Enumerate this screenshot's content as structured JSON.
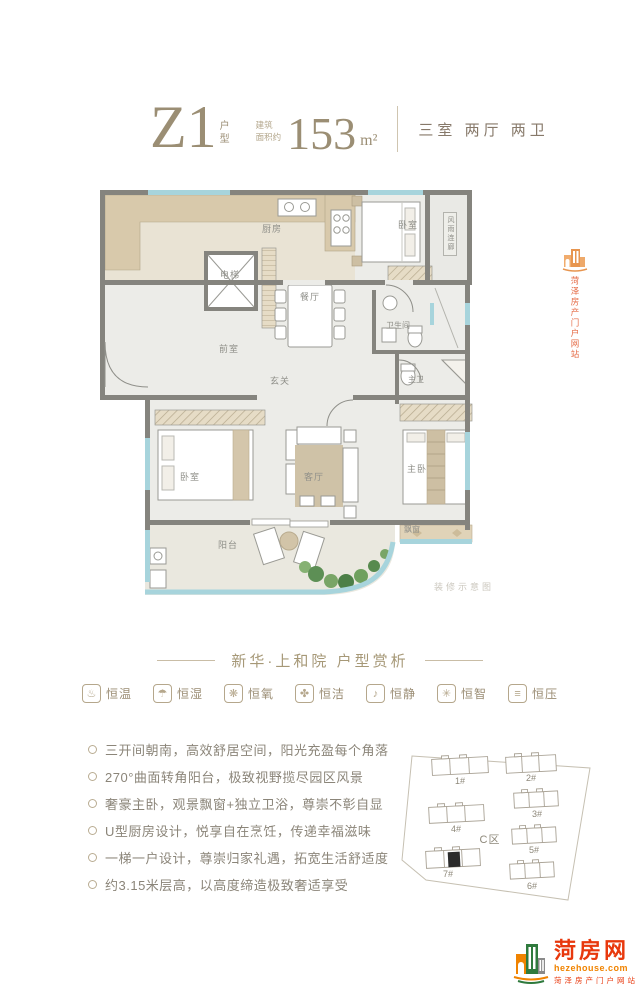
{
  "header": {
    "unit_code": "Z1",
    "unit_type_label_1": "户",
    "unit_type_label_2": "型",
    "area_prefix_line1": "建筑",
    "area_prefix_line2": "面积约",
    "area_value": "153",
    "area_unit": "m²",
    "rooms_summary": "三室 两厅 两卫"
  },
  "floor_plan": {
    "rooms": {
      "kitchen": "厨房",
      "bedroom_top": "卧室",
      "elevator": "电梯",
      "dining_room": "餐厅",
      "front_room": "前室",
      "foyer": "玄关",
      "bathroom": "卫生间",
      "master_bathroom": "主卫",
      "bedroom_left": "卧室",
      "living_room": "客厅",
      "master_bedroom": "主卧",
      "balcony": "阳台",
      "bay_window": "飘窗",
      "corridor": "风雨连廊"
    },
    "note": "装修示意图"
  },
  "watermark": {
    "vertical_text": "菏泽房产门户网站"
  },
  "section_title": "新华·上和院 户型赏析",
  "features": [
    {
      "name": "thermometer-icon",
      "glyph": "♨",
      "label": "恒温"
    },
    {
      "name": "water-drop-icon",
      "glyph": "☂",
      "label": "恒湿"
    },
    {
      "name": "fan-icon",
      "glyph": "❋",
      "label": "恒氧"
    },
    {
      "name": "clean-brush-icon",
      "glyph": "✤",
      "label": "恒洁"
    },
    {
      "name": "bell-icon",
      "glyph": "♪",
      "label": "恒静"
    },
    {
      "name": "atom-icon",
      "glyph": "✳",
      "label": "恒智"
    },
    {
      "name": "pressure-icon",
      "glyph": "≡",
      "label": "恒压"
    }
  ],
  "selling_points": [
    "三开间朝南，高效舒居空间，阳光充盈每个角落",
    "270°曲面转角阳台，极致视野揽尽园区风景",
    "奢豪主卧，观景飘窗+独立卫浴，尊崇不彰自显",
    "U型厨房设计，悦享自在烹饪，传递幸福滋味",
    "一梯一户设计，尊崇归家礼遇，拓宽生活舒适度",
    "约3.15米层高，以高度缔造极致奢适享受"
  ],
  "site_plan": {
    "zone_label": "C区",
    "buildings": [
      "1#",
      "2#",
      "3#",
      "4#",
      "5#",
      "6#",
      "7#"
    ],
    "highlighted_building": "7#"
  },
  "logo": {
    "name": "菏房网",
    "domain": "hezehouse.com",
    "tagline": "菏泽房产门户网站"
  },
  "colors": {
    "accent_tan": "#a3957c",
    "wall_gray": "#85847e",
    "window_blue": "#a7d4dc",
    "logo_red": "#e8380d",
    "logo_orange": "#f08300"
  }
}
